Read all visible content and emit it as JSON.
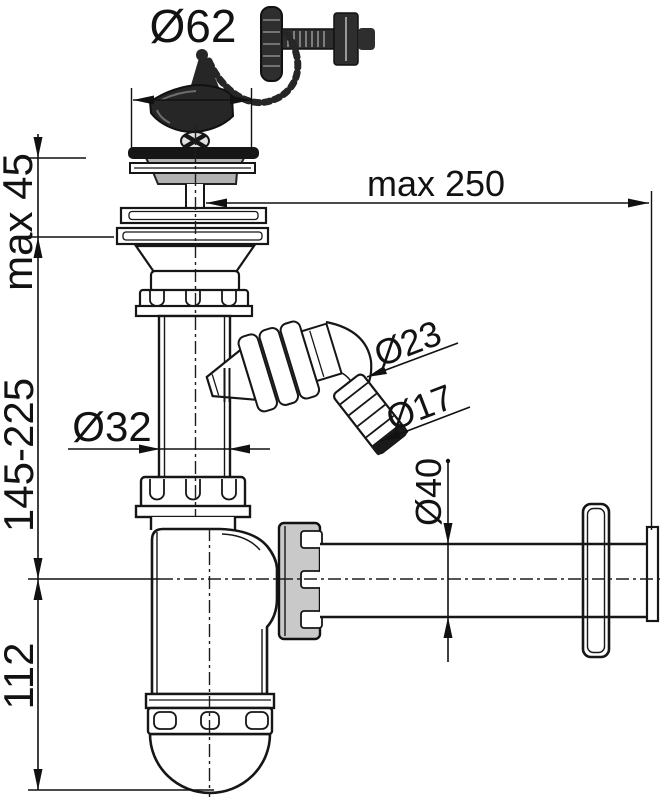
{
  "drawing": {
    "labels": {
      "strainer_diameter": "Ø62",
      "wall_distance_max": "max 250",
      "sink_thickness_max": "max 45",
      "height_adjustable_range": "145-225",
      "trap_bottom_height": "112",
      "tailpipe_diameter": "Ø32",
      "overflow_hose_large_diameter": "Ø23",
      "overflow_hose_small_diameter": "Ø17",
      "outlet_pipe_diameter": "Ø40"
    },
    "colors": {
      "line": "#161616",
      "dark_fill": "#262626",
      "strainer_gray": "#b2b2b2",
      "nut_gray": "#c9c9c9",
      "background": "#ffffff"
    }
  }
}
